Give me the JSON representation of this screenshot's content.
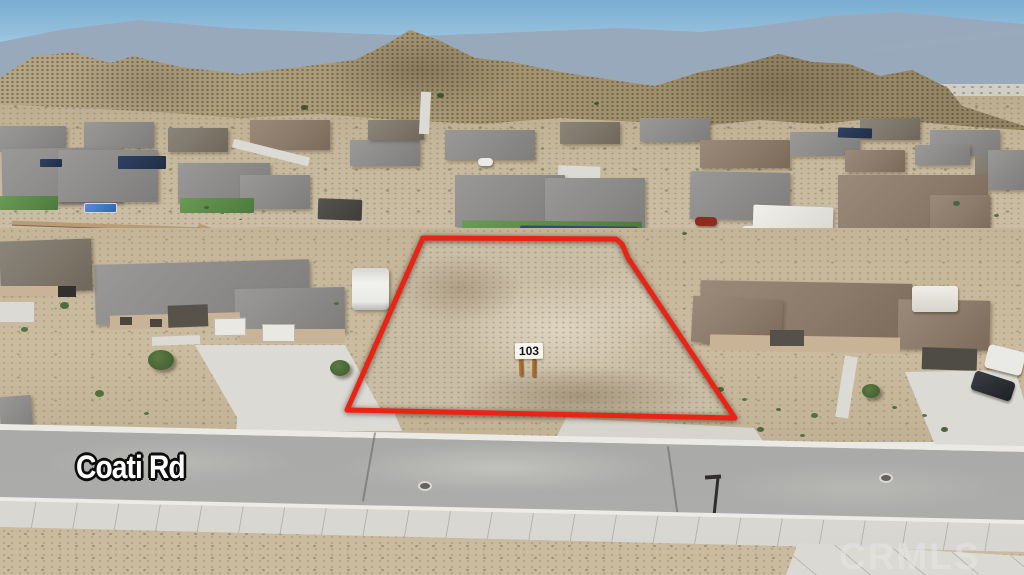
{
  "meta": {
    "type": "aerial-drone-photo",
    "scene": "Vacant desert residential lot outlined in red beside new single-story homes, mountains in background"
  },
  "labels": {
    "street_name": "Coati Rd",
    "lot_sign_number": "103",
    "watermark": "CRMLS"
  },
  "colors": {
    "lot_outline_red": "#ea2314",
    "sky_top": "#79add2",
    "sky_horizon": "#dde8ef",
    "distant_ridge_blue": "#8c9cb2",
    "mountain_tan": "#a3946f",
    "desert_ground": "#c6b89c",
    "lot_dirt": "#cbbfa8",
    "road_asphalt": "#a5a5a3",
    "sidewalk_concrete": "#dcdbd6",
    "roof_gray": "#8b8a88",
    "roof_brown": "#8b7a69",
    "pool_blue": "#2f63b4",
    "lawn_green": "#4d7a3c",
    "sign_post_wood": "#a06a28"
  }
}
